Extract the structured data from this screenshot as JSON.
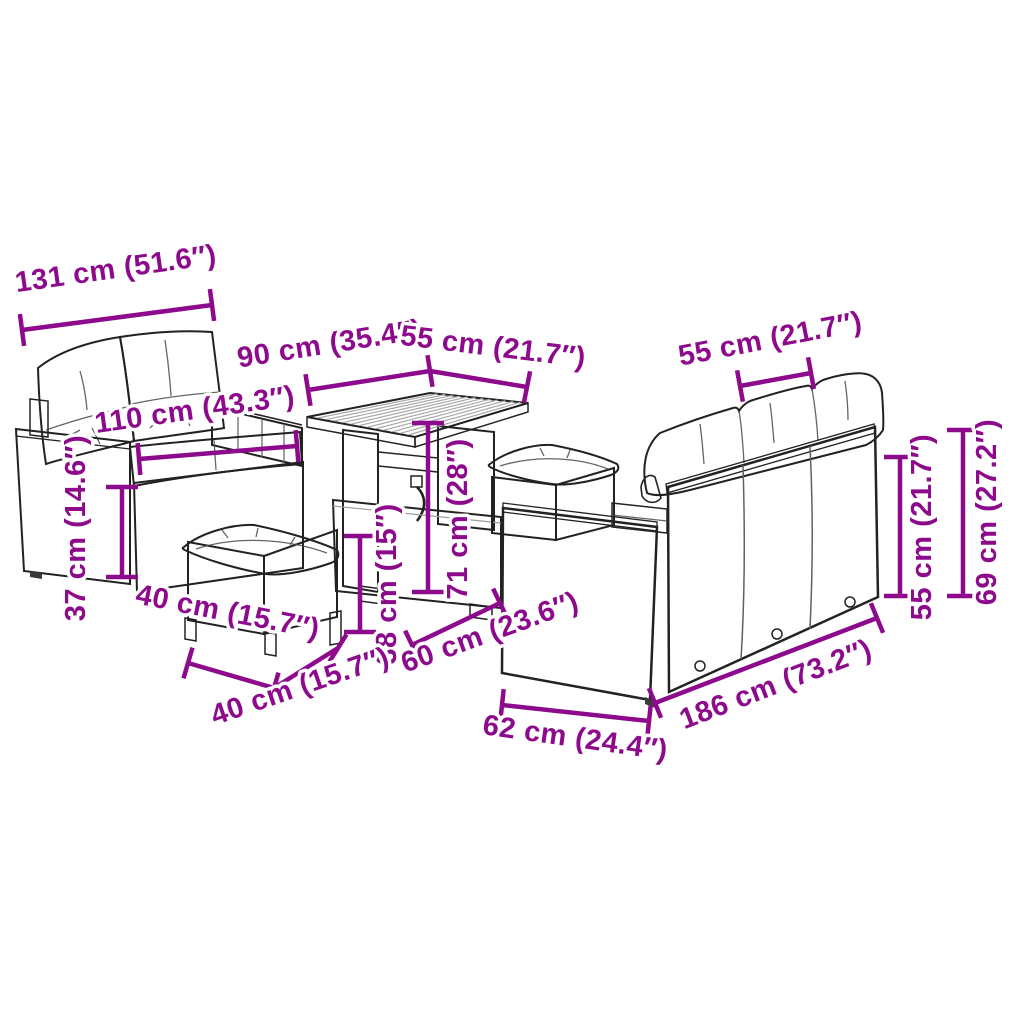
{
  "image_type": "product dimension diagram",
  "product": "garden rattan lounge set with sofas, table and footstools",
  "colors": {
    "dimension_annotation": "#8d0a8d",
    "outline": "#222222",
    "rattan_gray": "#9a9a9a",
    "cushion": "#ffffff",
    "background": "#ffffff"
  },
  "dimensions": {
    "sofa2_width": "131 cm (51.6″)",
    "sofa2_inner_width": "110 cm (43.3″)",
    "sofa2_seat_height": "37 cm (14.6″)",
    "table_length": "90 cm (35.4″)",
    "table_width": "55 cm (21.7″)",
    "table_height": "71 cm (28″)",
    "stool_width": "40 cm (15.7″)",
    "stool_depth": "40 cm (15.7″)",
    "stool_height": "38 cm (15″)",
    "table_base_depth": "60 cm (23.6″)",
    "sofa3_cushion_width": "55 cm (21.7″)",
    "sofa3_back_height": "55 cm (21.7″)",
    "sofa3_total_height": "69 cm (27.2″)",
    "sofa3_depth": "62 cm (24.4″)",
    "sofa3_length": "186 cm (73.2″)"
  }
}
